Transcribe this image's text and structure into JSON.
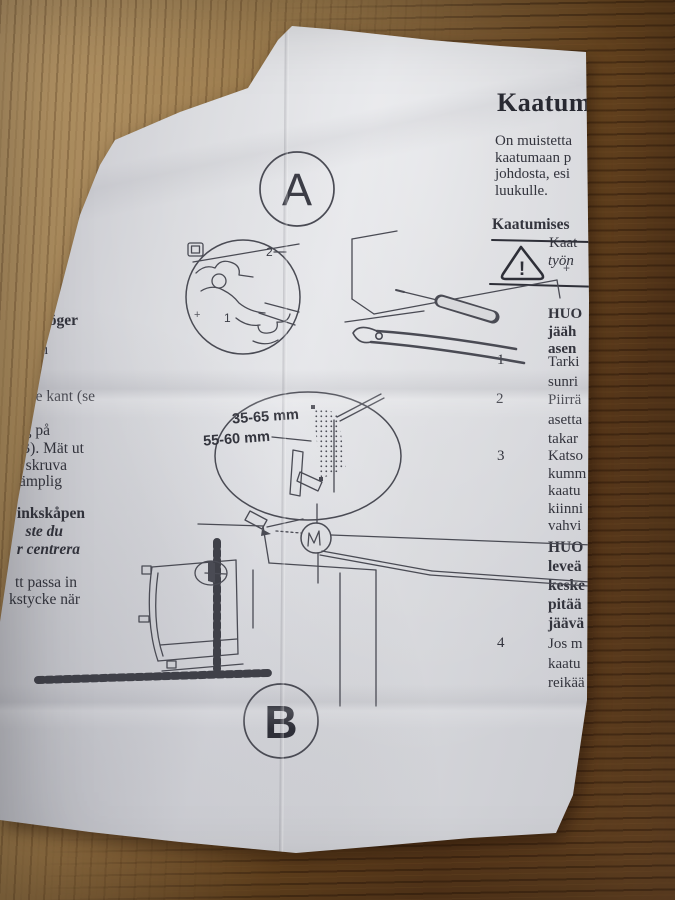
{
  "colors": {
    "paper": "#d6d7db",
    "ink": "#33343d",
    "wood_light": "#b09365",
    "wood_dark": "#55361a"
  },
  "labels": {
    "badge_a": "A",
    "badge_b": "B",
    "callout_1": "1",
    "callout_2": "2",
    "plus": "+",
    "dim_top": "35-65 mm",
    "dim_bottom": "55-60 mm",
    "warning_mark": "!"
  },
  "left_column": {
    "lines": [
      "te ska kunna",
      "r barn",
      "l när",
      "kan",
      "så höger",
      "och",
      "re kant (se",
      "ng på",
      "B). Mät ut",
      "skruva",
      "ämplig",
      "inkskåpen",
      "ste du",
      "r centrera",
      "tt passa in",
      "kstycke när"
    ]
  },
  "right_column": {
    "heading": "Kaatum",
    "intro": [
      "On muistetta",
      "kaatumaan p",
      "johdosta, esi",
      "luukulle."
    ],
    "warning_header": "Kaatumises",
    "warning_lines": [
      "Kaat",
      "työn"
    ],
    "note": [
      "HUO",
      "jääh",
      "asen"
    ],
    "steps": [
      {
        "num": "1",
        "lines": [
          "Tarki",
          "sunri"
        ]
      },
      {
        "num": "2",
        "lines": [
          "Piirrä",
          "asetta",
          "takar"
        ]
      },
      {
        "num": "3",
        "lines": [
          "Katso",
          "kumm",
          "kaatu",
          "kiinni",
          "vahvi"
        ]
      }
    ],
    "note_bold": [
      "HUO",
      "leveä",
      "keske",
      "pitää",
      "jäävä"
    ],
    "step4": {
      "num": "4",
      "lines": [
        "Jos m",
        "kaatu",
        "reikää"
      ]
    }
  }
}
